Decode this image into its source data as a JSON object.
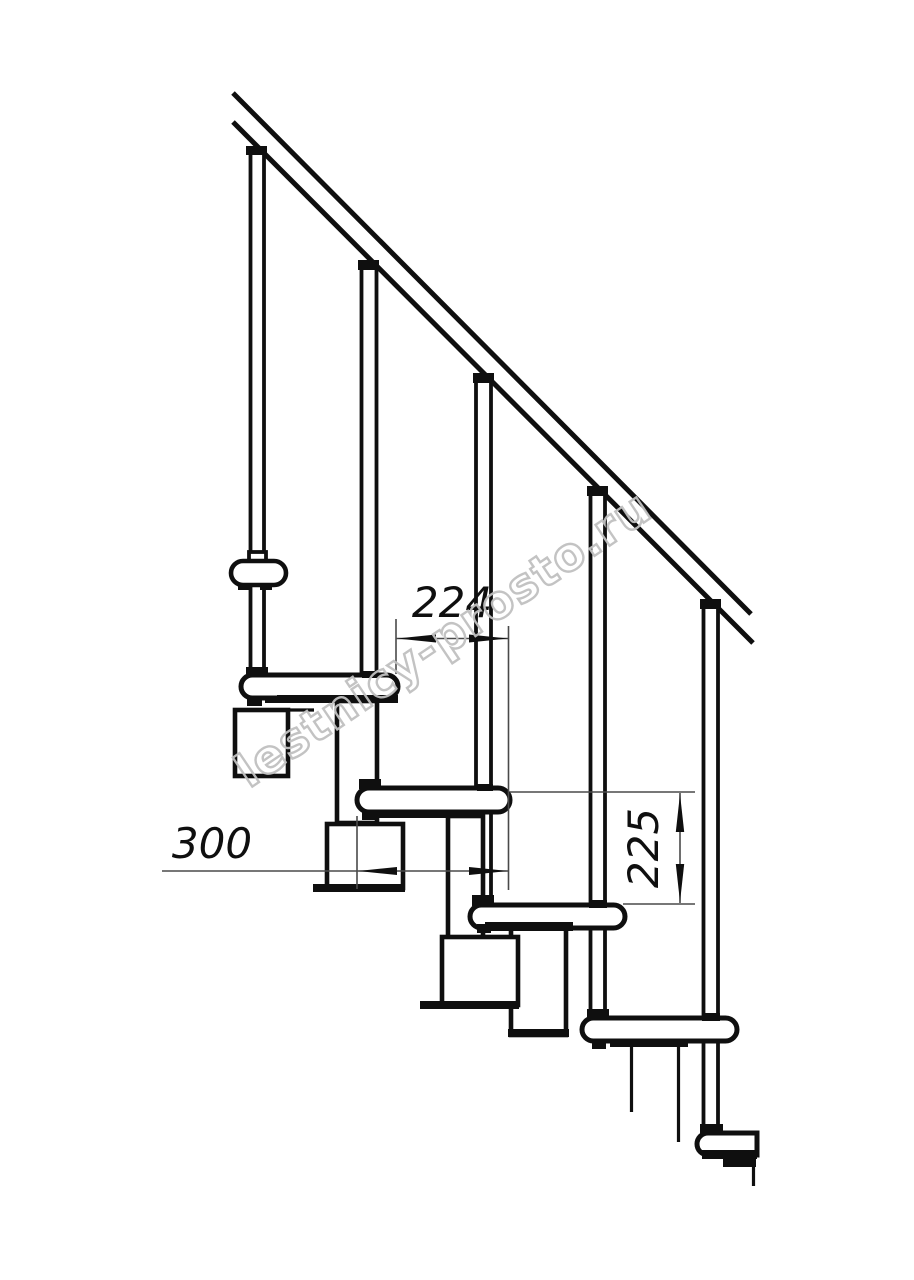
{
  "dimensions": {
    "run": {
      "value": "224"
    },
    "depth": {
      "value": "300"
    },
    "rise": {
      "value": "225"
    }
  },
  "watermark": {
    "text": "lestnicy-prosto.ru"
  },
  "colors": {
    "line": "#0f0f0f",
    "dim": "#4a4a4a",
    "watermark": "#c0c0c0",
    "background": "#ffffff"
  }
}
